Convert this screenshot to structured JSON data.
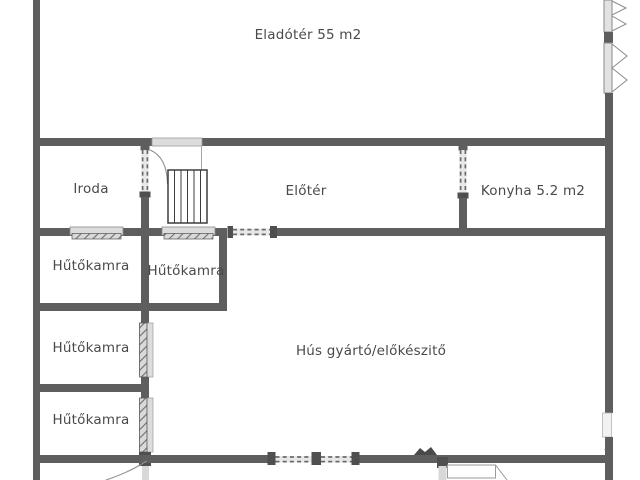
{
  "document_type": "floor-plan",
  "colors": {
    "background": "#ffffff",
    "wall": "#5e5e5e",
    "wall_dark": "#4a4a4a",
    "opening_light": "#e2e2e2",
    "hatch_line": "#6f6f6f",
    "thin_line": "#8f8f8f",
    "text": "#4a4a4a"
  },
  "rooms": {
    "eladoter": {
      "label": "Eladótér 55 m2"
    },
    "iroda": {
      "label": "Iroda"
    },
    "eloter": {
      "label": "Előtér"
    },
    "konyha": {
      "label": "Konyha 5.2 m2"
    },
    "hutokamra_a": {
      "label": "Hűtőkamra"
    },
    "hutokamra_b": {
      "label": "Hűtőkamra"
    },
    "hutokamra_c": {
      "label": "Hűtőkamra"
    },
    "hutokamra_d": {
      "label": "Hűtőkamra"
    },
    "hus_gyarto": {
      "label": "Hús gyártó/előkészitő"
    }
  }
}
